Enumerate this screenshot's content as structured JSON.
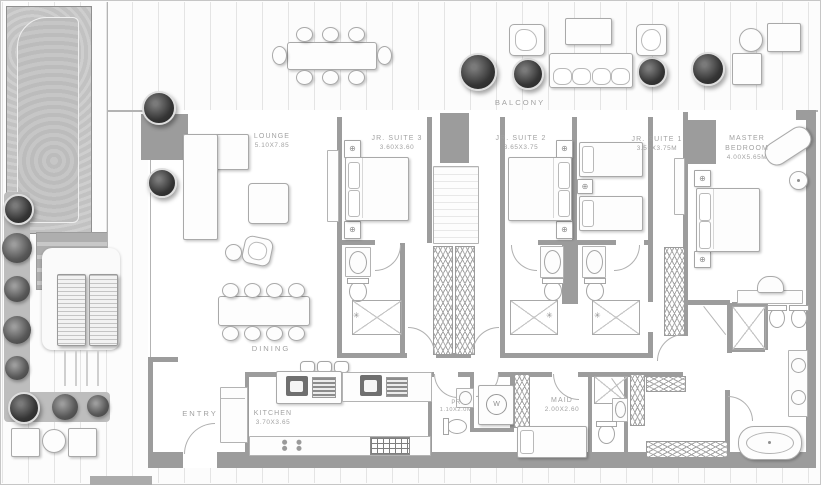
{
  "plan": {
    "areas": {
      "balcony": "BALCONY",
      "dining": "DINING",
      "entry": "ENTRY"
    },
    "rooms": {
      "lounge": {
        "name": "LOUNGE",
        "dims": "5.10X7.85"
      },
      "jr_suite_3": {
        "name": "JR. SUITE 3",
        "dims": "3.60X3.60"
      },
      "jr_suite_2": {
        "name": "JR. SUITE 2",
        "dims": "3.65X3.75"
      },
      "jr_suite_1": {
        "name": "JR. SUITE 1",
        "dims": "3.55X3.75M"
      },
      "master_bedroom": {
        "name": "MASTER BEDROOM",
        "dims": "4.00X5.65M"
      },
      "kitchen": {
        "name": "KITCHEN",
        "dims": "3.70X3.65"
      },
      "powder_room": {
        "name": "PR",
        "dims": "1.10X2.0M"
      },
      "maid_room": {
        "name": "MAID",
        "dims": "2.00X2.60"
      }
    },
    "appliances": {
      "washer_label": "W"
    },
    "icons": {
      "lamp_glyph": "⊕",
      "shower_head_glyph": "✳"
    },
    "colors": {
      "wall": "#9c9c9c",
      "text": "#a2a2a2",
      "plant": "#353535",
      "deck_line": "#e4e4e4"
    }
  }
}
